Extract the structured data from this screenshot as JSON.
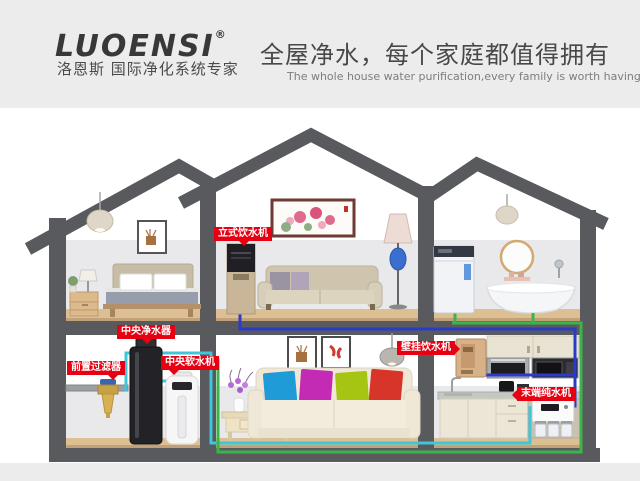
{
  "brand": {
    "name": "LUOENSI",
    "registered_mark": "®",
    "tagline": "洛恩斯 国际净化系统专家"
  },
  "headline": {
    "title": "全屋净水，每个家庭都值得拥有",
    "subtitle": "The whole house water purification,every family is worth having"
  },
  "device_labels": [
    {
      "id": "vertical-dispenser",
      "text": "立式饮水机"
    },
    {
      "id": "central-water-purifier",
      "text": "中央净水器"
    },
    {
      "id": "pre-filter",
      "text": "前置过滤器"
    },
    {
      "id": "central-water-softener",
      "text": "中央软水机"
    },
    {
      "id": "wall-mounted-dispenser",
      "text": "壁挂饮水机"
    },
    {
      "id": "terminal-pure-water-machine",
      "text": "末端纯水机"
    }
  ],
  "colors": {
    "label_bg": "#e60012",
    "pipe_cyan": "#3fc6da",
    "pipe_green": "#3bb549",
    "pipe_blue": "#2b3bc8",
    "wall": "#595a5e",
    "header_bg": "#ececec"
  }
}
